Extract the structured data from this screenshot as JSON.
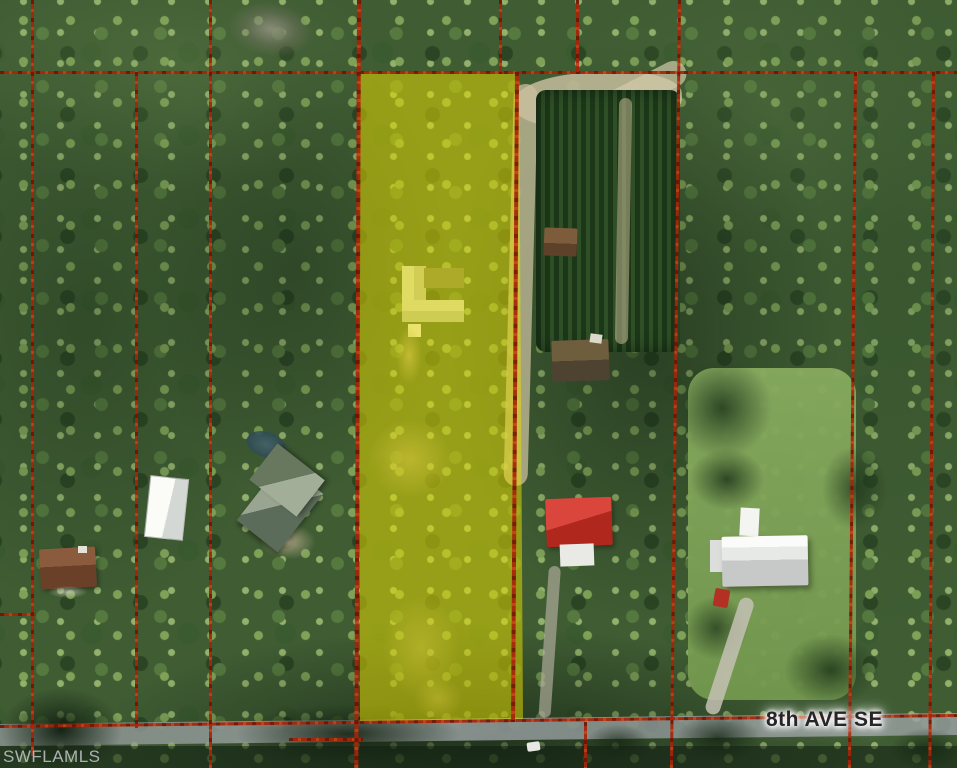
{
  "labels": {
    "street": "8th AVE SE",
    "watermark": "SWFLAMLS"
  },
  "colors": {
    "parcel-line": "#a82408",
    "highlight-yellow": "#e8dc00",
    "street-label-text": "#26262a",
    "watermark-text": "#babdbf",
    "canopy-base": "#3f5c33"
  }
}
